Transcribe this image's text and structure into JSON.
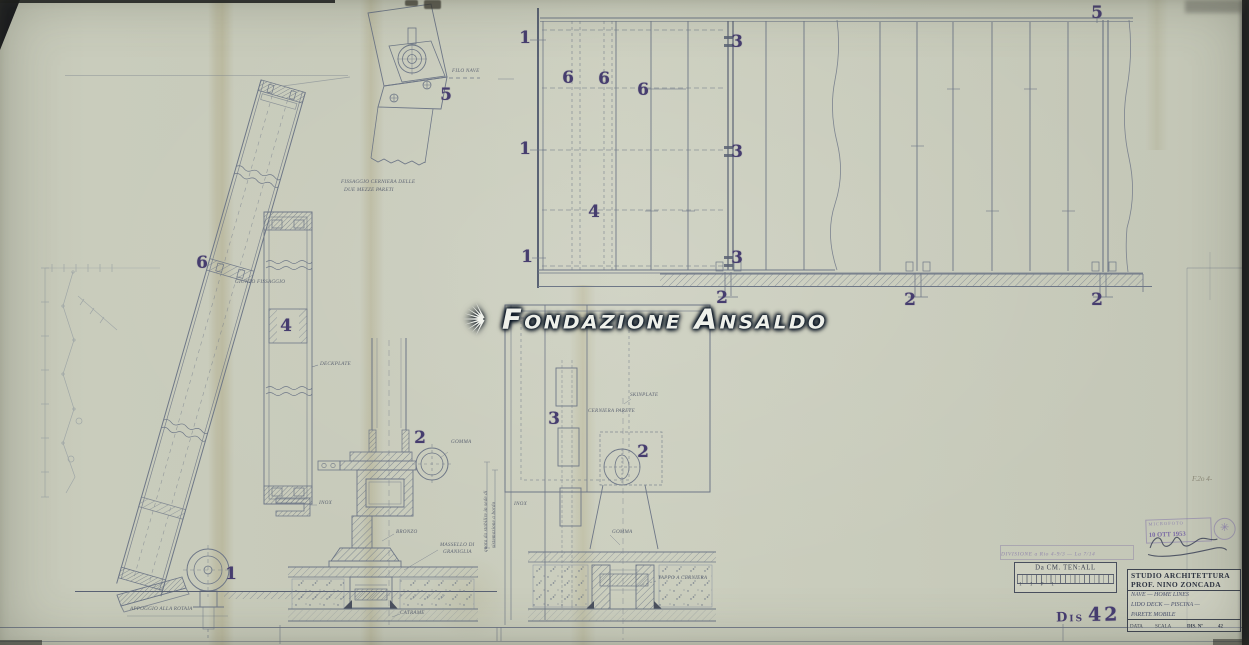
{
  "watermark": {
    "text": "Fondazione Ansaldo",
    "icon": "ansaldo-rays-icon"
  },
  "callouts": [
    {
      "text": "5"
    },
    {
      "text": "6"
    },
    {
      "text": "1"
    },
    {
      "text": "4"
    },
    {
      "text": "2"
    },
    {
      "text": "3"
    },
    {
      "text": "2"
    },
    {
      "text": "1"
    },
    {
      "text": "1"
    },
    {
      "text": "1"
    },
    {
      "text": "6"
    },
    {
      "text": "6"
    },
    {
      "text": "6"
    },
    {
      "text": "4"
    },
    {
      "text": "3"
    },
    {
      "text": "3"
    },
    {
      "text": "3"
    },
    {
      "text": "2"
    },
    {
      "text": "2"
    },
    {
      "text": "2"
    },
    {
      "text": "5"
    }
  ],
  "annotations": [
    {
      "text": "FILO NAVE"
    },
    {
      "text": "FISSAGGIO CERNIERA DELLE"
    },
    {
      "text": "DUE MEZZE PARETI"
    },
    {
      "text": "GIUNTO FISSAGGIO"
    },
    {
      "text": "DECKPLATE"
    },
    {
      "text": "APPOGGIO ALLA ROTAIA"
    },
    {
      "text": "INOX"
    },
    {
      "text": "GOMMA"
    },
    {
      "text": "BRONZO"
    },
    {
      "text": "MASSELLO DI"
    },
    {
      "text": "GRANIGLIA"
    },
    {
      "text": "CATRAME"
    },
    {
      "text": "CERNIERA PARETE"
    },
    {
      "text": "SKINPLATE"
    },
    {
      "text": "INOX"
    },
    {
      "text": "GOMMA"
    },
    {
      "text": "TAPPO A CERNIERA"
    },
    {
      "text": "quota da stabilire in sede di"
    },
    {
      "text": "sistemazione a bordo"
    },
    {
      "text": "F.2o 4-"
    }
  ],
  "stamps": {
    "division_line": "DIVISIONE a Rio 4-9/3 — La 7/14",
    "scale_box_title": "Da CM. TEN:ALL",
    "scale_box_marks": "1      1      P 1",
    "dis_prefix": "Dis",
    "dis_number": "42",
    "microfilm_line1": "MICROFOTO",
    "microfilm_date": "10 OTT 1953",
    "pencil_note": "F.2o 4-"
  },
  "title_block": {
    "studio_line1": "STUDIO  ARCHITETTURA",
    "studio_line2": "PROF.  NINO  ZONCADA",
    "project_lines": [
      "NAVE — HOME LINES",
      "LIDO DECK — PISCINA —",
      "PARETE MOBILE"
    ],
    "fields": {
      "data_label": "DATA",
      "scala_label": "SCALA",
      "dis_label": "DIS. Nº",
      "dis_value": "42"
    }
  }
}
